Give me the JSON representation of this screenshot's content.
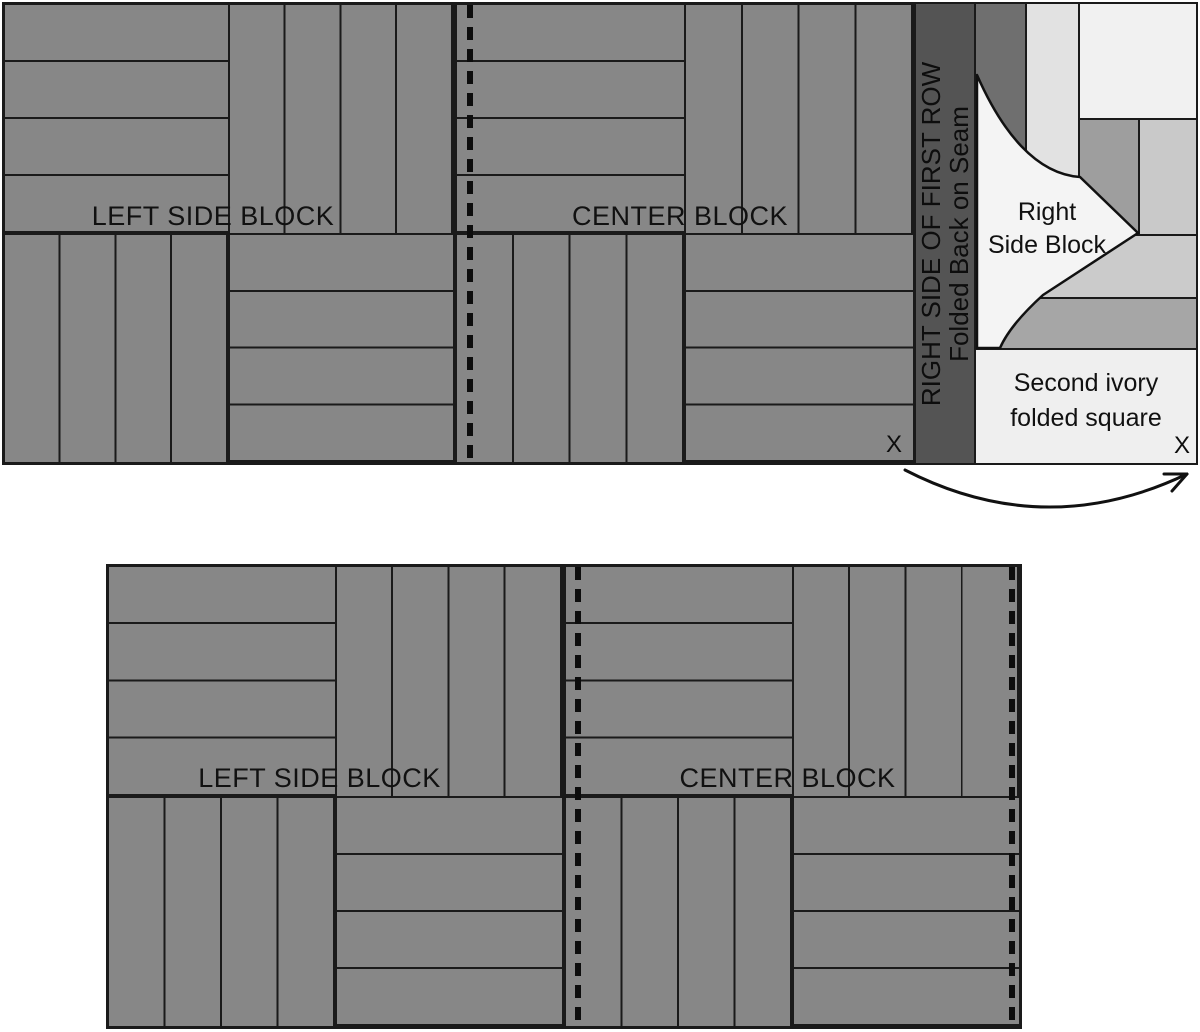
{
  "figure": {
    "description": "Quilt assembly diagram with rail fence blocks",
    "background": "#ffffff"
  },
  "colors": {
    "block_gray": "#878787",
    "outline_black": "#1a1a1a",
    "seam_strip_dark": "#545454",
    "rsb_strip_dark": "#6f6f6f",
    "rsb_strip_light": "#e2e2e2",
    "ivory_square": "#f1f1f1",
    "rsb_strip_medium": "#9e9e9e",
    "rsb_strip_pale": "#c9c9c9",
    "band_light": "#cbcbcb",
    "band_medium": "#a6a6a6",
    "second_ivory_square": "#efefef",
    "fold_ivory": "#f4f4f4"
  },
  "top_row": {
    "left_block": {
      "label": "LEFT SIDE BLOCK"
    },
    "center_block": {
      "label": "CENTER BLOCK",
      "x_mark": "X"
    },
    "seam_strip": {
      "line1": "RIGHT SIDE OF FIRST ROW",
      "line2": "Folded Back on Seam"
    },
    "right_side_block": {
      "line1": "Right",
      "line2": "Side Block"
    },
    "second_ivory_square": {
      "line1": "Second ivory",
      "line2": "folded square",
      "x_mark": "X"
    }
  },
  "bottom_row": {
    "left_block": {
      "label": "LEFT SIDE BLOCK"
    },
    "center_block": {
      "label": "CENTER BLOCK"
    }
  }
}
